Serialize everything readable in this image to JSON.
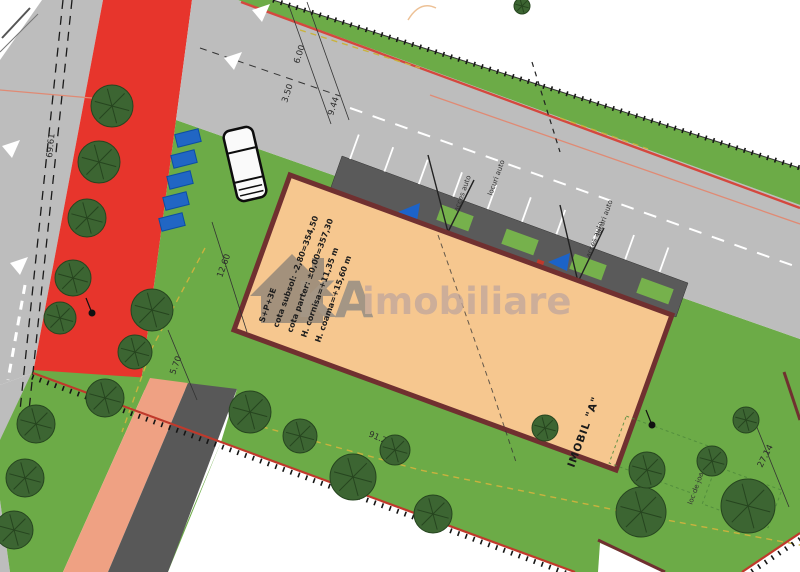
{
  "watermark": {
    "brand_bold": "KA",
    "brand_rest": "imobiliare"
  },
  "building": {
    "label": "IMOBIL \"A\"",
    "annotations": [
      "S+P+3E",
      "cota subsol: -2,80=354,50",
      "cota parter: ±0,00=357,30",
      "H. cornisa=+11,35 m",
      "H. coama=+15,60 m"
    ]
  },
  "dimensions": {
    "road_left": "69.61",
    "chain_top": [
      "6.00",
      "3.50",
      "9.44"
    ],
    "side_upper": "12.60",
    "side_lower": "5.70",
    "boundary_bottom": "91.22",
    "boundary_right": "27.14"
  },
  "parking": {
    "access_label": "acces auto",
    "stalls_label": "locuri auto",
    "playground_label": "loc de joaca"
  },
  "colors": {
    "grass": "#6cab47",
    "road": "#bdbdbd",
    "red_zone": "#e7352c",
    "salmon": "#efa183",
    "sidewalk": "#585858",
    "band": "#5a5a5a",
    "building_fill": "#f6c78f",
    "building_border": "#703030",
    "tree": "#3c6532",
    "tree_line": "#26451f",
    "blue": "#2166c4",
    "boundary_red": "#c0392b",
    "dim": "#2b2b2b",
    "yellow_line": "#c9b23e",
    "salmon_line": "#e08a74",
    "wm_gray": "#8d8277",
    "wm_text": "#8e8983",
    "wm_pink": "#c2a79c"
  }
}
